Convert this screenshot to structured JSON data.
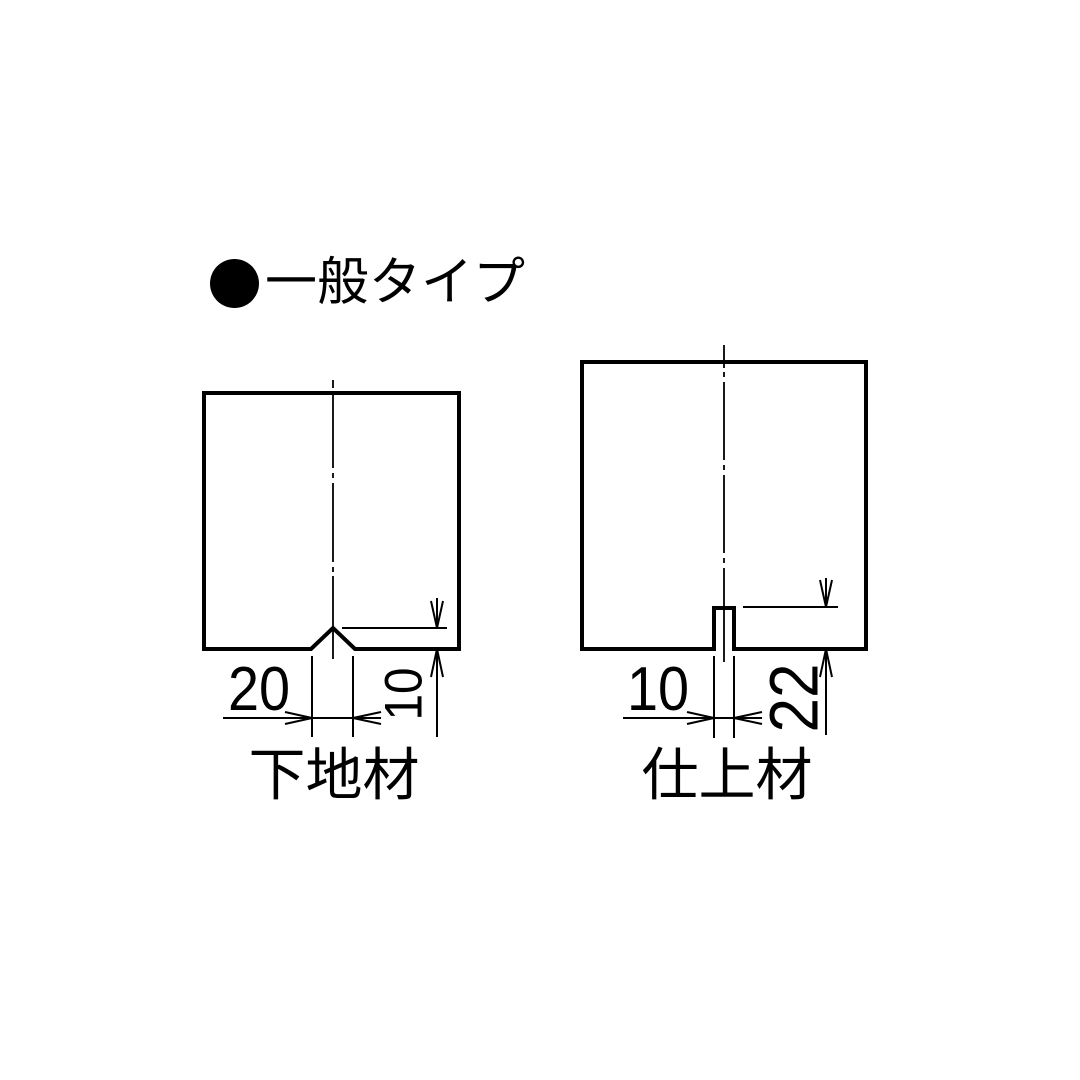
{
  "page": {
    "colors": {
      "background": "#ffffff",
      "line": "#000000",
      "text": "#000000"
    }
  },
  "title": {
    "icon": "bullet-circle-icon",
    "text": "一般タイプ"
  },
  "figures": [
    {
      "id": "base-material",
      "label": "下地材",
      "profile": "v-groove-notch",
      "dimensions": {
        "notch_width": "20",
        "notch_depth": "10"
      }
    },
    {
      "id": "finish-material",
      "label": "仕上材",
      "profile": "rectangular-slot",
      "dimensions": {
        "slot_width": "10",
        "slot_depth": "22"
      }
    }
  ]
}
